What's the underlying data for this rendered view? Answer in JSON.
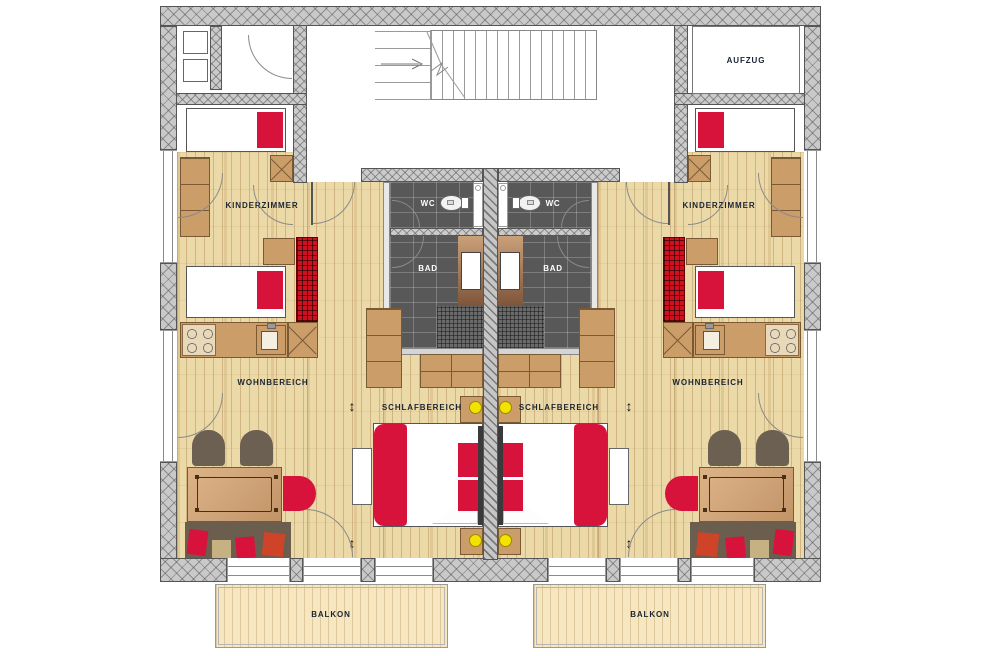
{
  "document": {
    "type": "architectural-floor-plan",
    "description": "Two mirrored apartment units with shared stair hall, elevator and balconies"
  },
  "labels": {
    "elevator": "AUFZUG"
  },
  "glyphs": {
    "slide_arrow": "↕"
  },
  "apartments": [
    {
      "side": "left",
      "kinderzimmer_label": "KINDERZIMMER",
      "wohnbereich_label": "WOHNBEREICH",
      "schlafbereich_label": "SCHLAFBEREICH",
      "wc_label": "WC",
      "bad_label": "BAD",
      "balkon_label": "BALKON"
    },
    {
      "side": "right",
      "kinderzimmer_label": "KINDERZIMMER",
      "wohnbereich_label": "WOHNBEREICH",
      "schlafbereich_label": "SCHLAFBEREICH",
      "wc_label": "WC",
      "bad_label": "BAD",
      "balkon_label": "BALKON"
    }
  ],
  "colors": {
    "accent_red": "#d8133b",
    "wood_floor": "#ecd9a8",
    "furniture_wood": "#cb9d69",
    "tile_dark": "#585858",
    "wall_gray": "#c9c9c9",
    "balcony_deck": "#f6e7c1",
    "lamp_yellow": "#f2e300",
    "chair_brown": "#6c6052",
    "label_dark": "#1b2433",
    "label_light": "#ffffff"
  }
}
